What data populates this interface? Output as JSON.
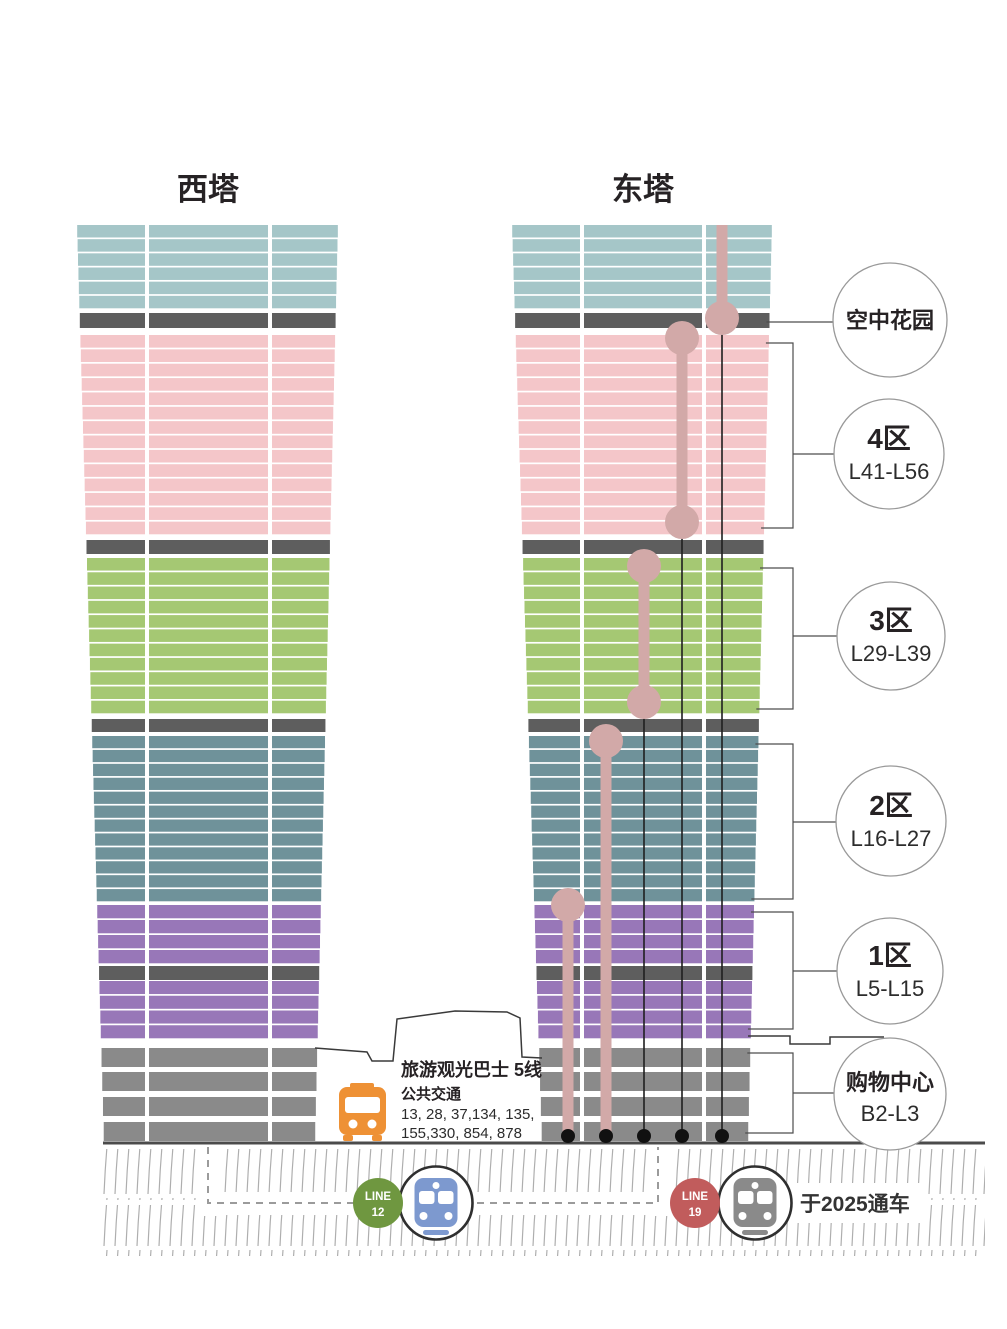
{
  "towers": {
    "west_label": "西塔",
    "east_label": "东塔"
  },
  "callouts": [
    {
      "title": "空中花园"
    },
    {
      "zone": "4区",
      "floors": "L41-L56"
    },
    {
      "zone": "3区",
      "floors": "L29-L39"
    },
    {
      "zone": "2区",
      "floors": "L16-L27"
    },
    {
      "zone": "1区",
      "floors": "L5-L15"
    },
    {
      "title": "购物中心",
      "floors": "B2-L3"
    }
  ],
  "bus": {
    "title": "旅游观光巴士 5线",
    "subtitle": "公共交通",
    "routes_line1": "13, 28, 37,134, 135,",
    "routes_line2": "155,330, 854, 878"
  },
  "metro": {
    "line12": {
      "label": "LINE",
      "number": "12"
    },
    "line19": {
      "label": "LINE",
      "number": "19"
    },
    "note": "于2025通车"
  },
  "colors": {
    "teal": "#a5c6c8",
    "pink": "#f4c6c9",
    "green": "#a5c873",
    "slate": "#6f929a",
    "purple": "#9877b8",
    "podium_gray": "#8a8a8a",
    "band_dark": "#5e5e5e",
    "elevator_rose": "#d2a9a8",
    "shaft_line": "#1f1f1f",
    "bus_orange": "#ee9135",
    "line12_green": "#6f9740",
    "line19_red": "#c15c5c",
    "train12_blue": "#7d99cf",
    "train19_gray": "#8a8a8a",
    "circle_border": "#999999",
    "bracket": "#4d4d4d",
    "ground": "#4b4b4b",
    "hatch": "#aeaeae",
    "dash": "#9b9b9b"
  }
}
